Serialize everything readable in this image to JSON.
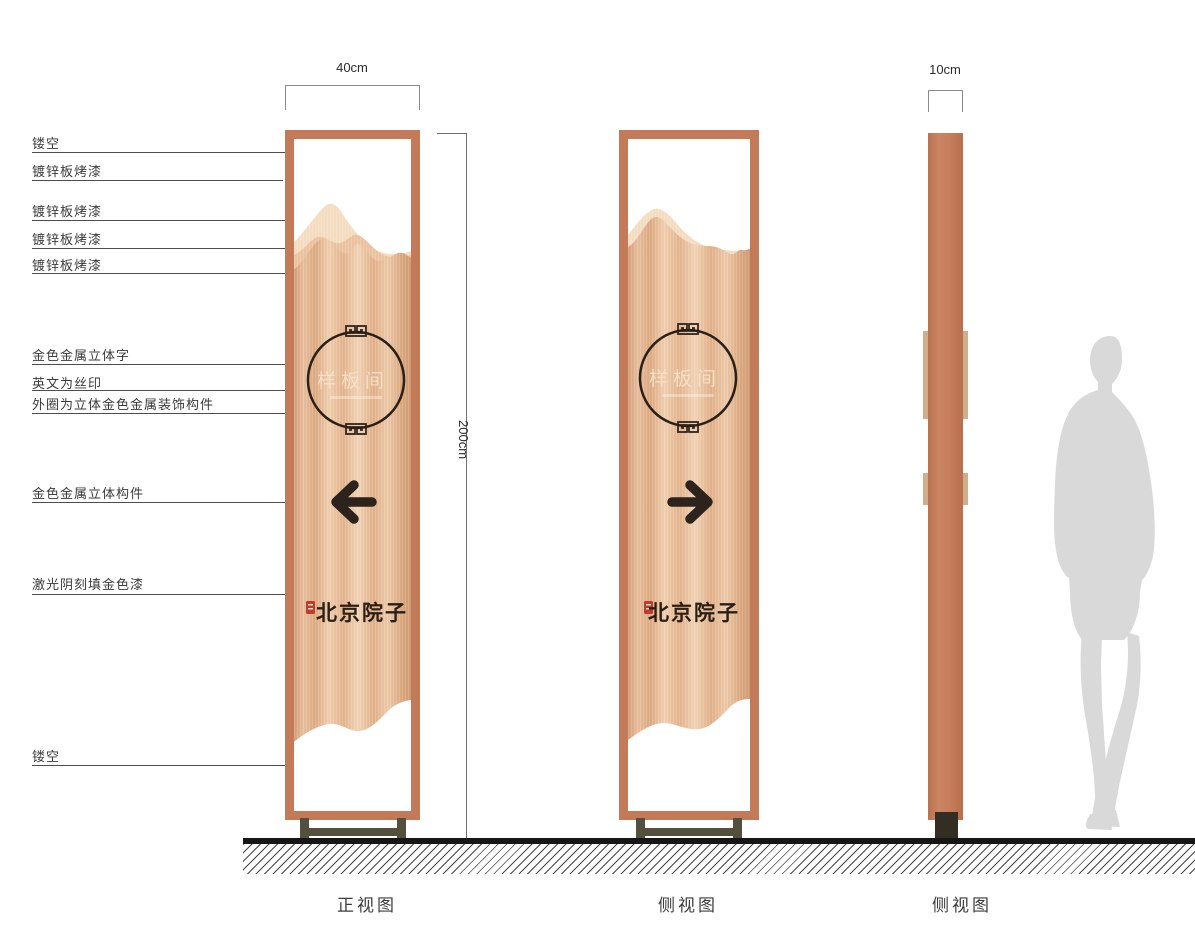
{
  "callouts": [
    {
      "label": "镂空"
    },
    {
      "label": "镀锌板烤漆"
    },
    {
      "label": "镀锌板烤漆"
    },
    {
      "label": "镀锌板烤漆"
    },
    {
      "label": "镀锌板烤漆"
    },
    {
      "label": "金色金属立体字"
    },
    {
      "label": "英文为丝印"
    },
    {
      "label": "外圈为立体金色金属装饰构件"
    },
    {
      "label": "金色金属立体构件"
    },
    {
      "label": "激光阴刻填金色漆"
    },
    {
      "label": "镂空"
    }
  ],
  "dims": {
    "front_width": "40cm",
    "height": "200cm",
    "side_width": "10cm"
  },
  "views": [
    {
      "label": "正视图"
    },
    {
      "label": "侧视图"
    },
    {
      "label": "侧视图"
    }
  ],
  "sign": {
    "emblem_text": "样板间",
    "brand_text": "北京院子"
  },
  "colors": {
    "frame": "#c37a59",
    "panel_highlight": "#f0d2b4",
    "panel_shadow": "#d29a74",
    "mountain_back": "#f4dcc0",
    "mountain_mid": "#eac2a0",
    "base": "#53503f",
    "artwork_dark": "#2c231c",
    "seal_red": "#c13a2a",
    "protrusion_tan": "#cfae89",
    "silhouette_gray": "#d9d9d9"
  }
}
